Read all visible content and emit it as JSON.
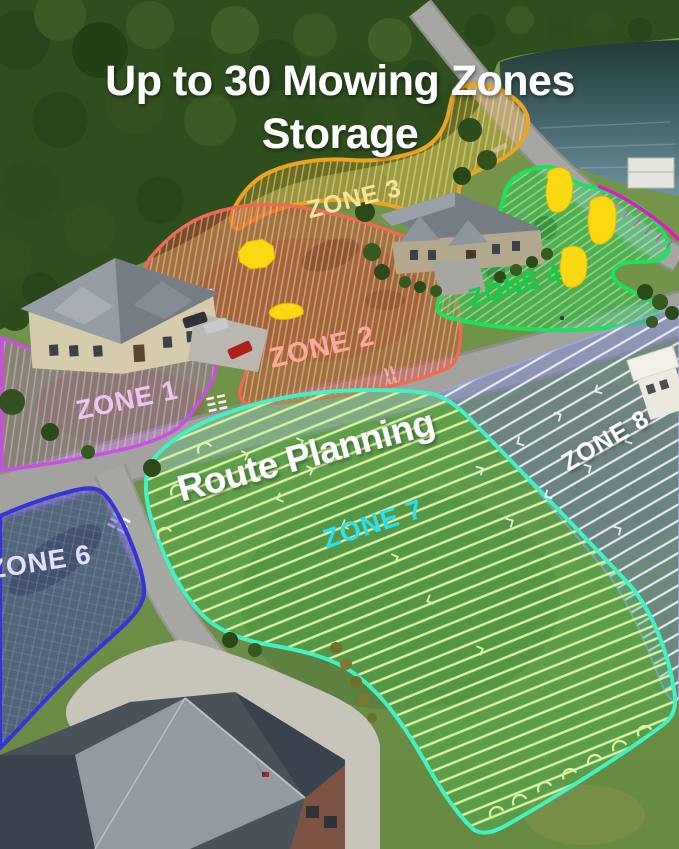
{
  "title": {
    "line1": "Up to 30 Mowing Zones",
    "line2": "Storage"
  },
  "overlay_labels": {
    "route_planning": "Route Planning"
  },
  "zones": [
    {
      "label": "ZONE 1",
      "outline_color": "#c94fe3",
      "label_color": "#f1c3f3"
    },
    {
      "label": "ZONE 2",
      "outline_color": "#ef6a55",
      "label_color": "#ffa89b"
    },
    {
      "label": "ZONE 3",
      "outline_color": "#eda521",
      "label_color": "#f6e49a"
    },
    {
      "label": "ZONE 4",
      "outline_color": "#1ee05a",
      "label_color": "#0ed04b"
    },
    {
      "label": "ZONE 6",
      "outline_color": "#3434d8",
      "label_color": "#e3e0fb"
    },
    {
      "label": "ZONE 7",
      "outline_color": "#43f2c3",
      "label_color": "#29dff0"
    },
    {
      "label": "ZONE 8",
      "outline_color": "#9aa8e8",
      "label_color": "#ffffff"
    }
  ],
  "scene": {
    "forest_color": "#2f4e1d",
    "lawn_color": "#7a9a4f",
    "water_color": "#5b7f8c",
    "road_color": "#a2a29e",
    "concrete_color": "#c7c4ba",
    "obstacle_marker_color": "#f8d912",
    "magenta_boundary_color": "#e316c8",
    "route_line_color": "#d9f5a0"
  }
}
